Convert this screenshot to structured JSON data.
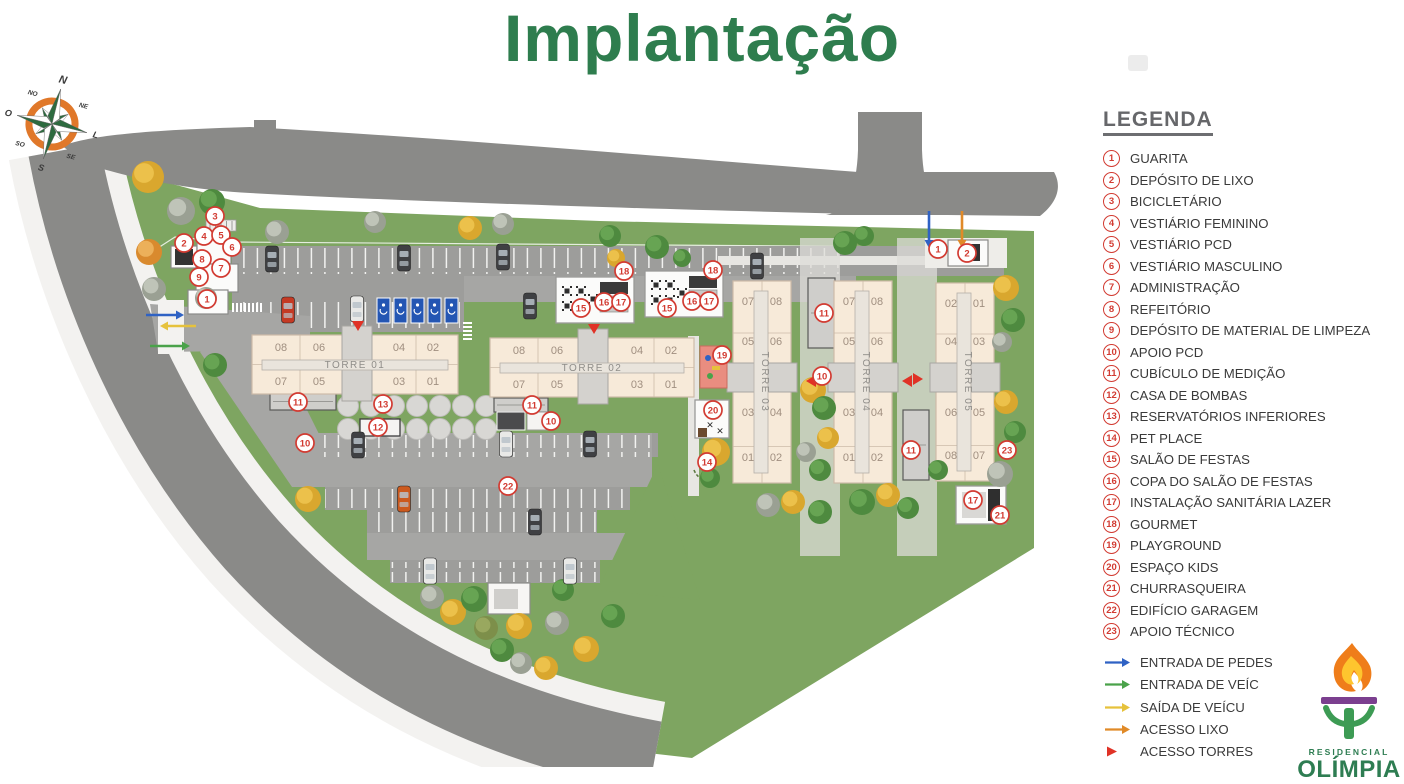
{
  "title": "Implantação",
  "legend": {
    "heading": "LEGENDA",
    "items": [
      {
        "n": "1",
        "label": "GUARITA"
      },
      {
        "n": "2",
        "label": "DEPÓSITO DE LIXO"
      },
      {
        "n": "3",
        "label": "BICICLETÁRIO"
      },
      {
        "n": "4",
        "label": "VESTIÁRIO FEMININO"
      },
      {
        "n": "5",
        "label": "VESTIÁRIO PCD"
      },
      {
        "n": "6",
        "label": "VESTIÁRIO MASCULINO"
      },
      {
        "n": "7",
        "label": "ADMINISTRAÇÃO"
      },
      {
        "n": "8",
        "label": "REFEITÓRIO"
      },
      {
        "n": "9",
        "label": "DEPÓSITO DE MATERIAL DE LIMPEZA"
      },
      {
        "n": "10",
        "label": "APOIO PCD"
      },
      {
        "n": "11",
        "label": "CUBÍCULO DE MEDIÇÃO"
      },
      {
        "n": "12",
        "label": "CASA DE BOMBAS"
      },
      {
        "n": "13",
        "label": "RESERVATÓRIOS INFERIORES"
      },
      {
        "n": "14",
        "label": "PET PLACE"
      },
      {
        "n": "15",
        "label": "SALÃO DE FESTAS"
      },
      {
        "n": "16",
        "label": "COPA DO SALÃO DE FESTAS"
      },
      {
        "n": "17",
        "label": "INSTALAÇÃO SANITÁRIA LAZER"
      },
      {
        "n": "18",
        "label": "GOURMET"
      },
      {
        "n": "19",
        "label": "PLAYGROUND"
      },
      {
        "n": "20",
        "label": "ESPAÇO KIDS"
      },
      {
        "n": "21",
        "label": "CHURRASQUEIRA"
      },
      {
        "n": "22",
        "label": "EDIFÍCIO GARAGEM"
      },
      {
        "n": "23",
        "label": "APOIO TÉCNICO"
      }
    ],
    "flows": [
      {
        "type": "arrow",
        "color": "#2f62c4",
        "label": "ENTRADA DE PEDES"
      },
      {
        "type": "arrow",
        "color": "#4aa24a",
        "label": "ENTRADA DE VEÍC"
      },
      {
        "type": "arrow",
        "color": "#e6c23c",
        "label": "SAÍDA DE  VEÍCU"
      },
      {
        "type": "arrow",
        "color": "#e08a28",
        "label": "ACESSO LIXO"
      },
      {
        "type": "triangle",
        "color": "#e03226",
        "label": "ACESSO TORRES"
      }
    ]
  },
  "logo": {
    "residencial": "RESIDENCIAL",
    "name": "OLÍMPIA"
  },
  "compass": {
    "labels": [
      "N",
      "NE",
      "L",
      "SE",
      "S",
      "SO",
      "O",
      "NO"
    ]
  },
  "plan": {
    "colors": {
      "grass": "#7ea561",
      "road": "#8a8a88",
      "sidewalk": "#f3f2f0",
      "lot": "#9d9d9b",
      "drive": "#a6a6a4",
      "slab": "#f7ead9",
      "slab_border": "#cdbba8",
      "core": "#d4d2ce",
      "bar": "#e9e4dc",
      "unit_text": "#a08f80",
      "tower_text": "#8f8d89",
      "marker": "#d23b32",
      "pcd": "#2456b3",
      "playground": "#e98d80",
      "arrow_blue": "#2f62c4",
      "arrow_green": "#4aa24a",
      "arrow_yellow": "#e6c23c",
      "arrow_orange": "#e08a28",
      "accent_red": "#e03226"
    },
    "towers": [
      {
        "name": "TORRE 01",
        "dir": "h",
        "slab": [
          252,
          335,
          206,
          59
        ],
        "core": [
          342,
          326,
          30,
          75
        ],
        "bar": [
          262,
          360,
          186,
          10
        ],
        "label": [
          355,
          368
        ],
        "cols": [
          281,
          319,
          399,
          433
        ],
        "rows": [
          351,
          385
        ],
        "units": [
          [
            "08",
            "06",
            "04",
            "02"
          ],
          [
            "07",
            "05",
            "03",
            "01"
          ]
        ]
      },
      {
        "name": "TORRE 02",
        "dir": "h",
        "slab": [
          490,
          338,
          204,
          59
        ],
        "core": [
          578,
          329,
          30,
          75
        ],
        "bar": [
          500,
          363,
          184,
          10
        ],
        "label": [
          592,
          371
        ],
        "cols": [
          519,
          557,
          637,
          671
        ],
        "rows": [
          354,
          388
        ],
        "units": [
          [
            "08",
            "06",
            "04",
            "02"
          ],
          [
            "07",
            "05",
            "03",
            "01"
          ]
        ]
      },
      {
        "name": "TORRE 03",
        "dir": "v",
        "slab": [
          733,
          281,
          58,
          202
        ],
        "core": [
          727,
          363,
          70,
          29
        ],
        "bar": [
          754,
          291,
          14,
          182
        ],
        "label": [
          762,
          382
        ],
        "cols": [
          748,
          776
        ],
        "rows": [
          305,
          345,
          416,
          461
        ],
        "units": [
          [
            "07",
            "08"
          ],
          [
            "05",
            "06"
          ],
          [
            "03",
            "04"
          ],
          [
            "01",
            "02"
          ]
        ]
      },
      {
        "name": "TORRE 04",
        "dir": "v",
        "slab": [
          834,
          281,
          58,
          202
        ],
        "core": [
          828,
          363,
          70,
          29
        ],
        "bar": [
          855,
          291,
          14,
          182
        ],
        "label": [
          863,
          382
        ],
        "cols": [
          849,
          877
        ],
        "rows": [
          305,
          345,
          416,
          461
        ],
        "units": [
          [
            "07",
            "08"
          ],
          [
            "05",
            "06"
          ],
          [
            "03",
            "04"
          ],
          [
            "01",
            "02"
          ]
        ]
      },
      {
        "name": "TORRE 05",
        "dir": "v",
        "slab": [
          936,
          283,
          58,
          198
        ],
        "core": [
          930,
          363,
          70,
          29
        ],
        "bar": [
          957,
          293,
          14,
          178
        ],
        "label": [
          965,
          382
        ],
        "cols": [
          951,
          979
        ],
        "rows": [
          307,
          345,
          416,
          459
        ],
        "units": [
          [
            "02",
            "01"
          ],
          [
            "04",
            "03"
          ],
          [
            "06",
            "05"
          ],
          [
            "08",
            "07"
          ]
        ]
      }
    ],
    "markers": [
      [
        "3",
        215,
        216
      ],
      [
        "4",
        204,
        236
      ],
      [
        "5",
        221,
        235
      ],
      [
        "2",
        184,
        243
      ],
      [
        "6",
        232,
        247
      ],
      [
        "8",
        202,
        259
      ],
      [
        "7",
        221,
        268
      ],
      [
        "9",
        199,
        277
      ],
      [
        "1",
        207,
        299
      ],
      [
        "18",
        624,
        271
      ],
      [
        "15",
        581,
        308
      ],
      [
        "16",
        604,
        302
      ],
      [
        "17",
        621,
        302
      ],
      [
        "18",
        713,
        270
      ],
      [
        "15",
        667,
        308
      ],
      [
        "16",
        692,
        301
      ],
      [
        "17",
        709,
        301
      ],
      [
        "1",
        938,
        249
      ],
      [
        "2",
        967,
        253
      ],
      [
        "11",
        298,
        402
      ],
      [
        "13",
        383,
        404
      ],
      [
        "12",
        378,
        427
      ],
      [
        "10",
        305,
        443
      ],
      [
        "11",
        532,
        405
      ],
      [
        "10",
        551,
        421
      ],
      [
        "19",
        722,
        355
      ],
      [
        "20",
        713,
        410
      ],
      [
        "14",
        707,
        462
      ],
      [
        "11",
        824,
        313
      ],
      [
        "10",
        822,
        376
      ],
      [
        "11",
        911,
        450
      ],
      [
        "23",
        1007,
        450
      ],
      [
        "17",
        973,
        500
      ],
      [
        "21",
        1000,
        515
      ],
      [
        "22",
        508,
        486
      ]
    ],
    "triangles": [
      [
        358,
        329,
        "d"
      ],
      [
        594,
        332,
        "d"
      ],
      [
        808,
        381,
        "l"
      ],
      [
        904,
        381,
        "l"
      ],
      [
        921,
        379,
        "r"
      ]
    ],
    "arrows": [
      [
        146,
        315,
        176,
        315,
        "#2f62c4"
      ],
      [
        196,
        326,
        168,
        326,
        "#e6c23c"
      ],
      [
        150,
        346,
        182,
        346,
        "#4aa24a"
      ],
      [
        929,
        211,
        929,
        240,
        "#2f62c4"
      ],
      [
        962,
        211,
        962,
        240,
        "#e08a28"
      ]
    ],
    "trees": [
      [
        148,
        177,
        16,
        "y"
      ],
      [
        181,
        211,
        14,
        "gy"
      ],
      [
        212,
        202,
        13,
        "g"
      ],
      [
        149,
        252,
        13,
        "o"
      ],
      [
        154,
        289,
        12,
        "gy"
      ],
      [
        206,
        298,
        11,
        "gy"
      ],
      [
        215,
        365,
        12,
        "g"
      ],
      [
        277,
        232,
        12,
        "gy"
      ],
      [
        375,
        222,
        11,
        "gy"
      ],
      [
        470,
        228,
        12,
        "y"
      ],
      [
        503,
        224,
        11,
        "gy"
      ],
      [
        616,
        258,
        9,
        "y"
      ],
      [
        682,
        258,
        9,
        "g"
      ],
      [
        610,
        236,
        11,
        "g"
      ],
      [
        657,
        247,
        12,
        "g"
      ],
      [
        845,
        243,
        12,
        "g"
      ],
      [
        864,
        236,
        10,
        "g"
      ],
      [
        1006,
        288,
        13,
        "y"
      ],
      [
        1013,
        320,
        12,
        "g"
      ],
      [
        1002,
        342,
        10,
        "gy"
      ],
      [
        1006,
        402,
        12,
        "y"
      ],
      [
        1015,
        432,
        11,
        "g"
      ],
      [
        1000,
        474,
        13,
        "gy"
      ],
      [
        813,
        390,
        13,
        "y"
      ],
      [
        824,
        408,
        12,
        "g"
      ],
      [
        828,
        438,
        11,
        "y"
      ],
      [
        806,
        452,
        10,
        "gy"
      ],
      [
        820,
        470,
        11,
        "g"
      ],
      [
        768,
        505,
        12,
        "gy"
      ],
      [
        793,
        502,
        12,
        "y"
      ],
      [
        820,
        512,
        12,
        "g"
      ],
      [
        862,
        502,
        13,
        "g"
      ],
      [
        888,
        495,
        12,
        "y"
      ],
      [
        908,
        508,
        11,
        "g"
      ],
      [
        938,
        470,
        10,
        "g"
      ],
      [
        716,
        452,
        14,
        "y"
      ],
      [
        710,
        478,
        10,
        "g"
      ],
      [
        308,
        499,
        13,
        "y"
      ],
      [
        432,
        597,
        12,
        "gy"
      ],
      [
        453,
        612,
        13,
        "y"
      ],
      [
        474,
        599,
        13,
        "g"
      ],
      [
        486,
        628,
        12,
        "ol"
      ],
      [
        519,
        626,
        13,
        "y"
      ],
      [
        557,
        623,
        12,
        "gy"
      ],
      [
        502,
        650,
        12,
        "g"
      ],
      [
        521,
        663,
        11,
        "gy"
      ],
      [
        546,
        668,
        12,
        "y"
      ],
      [
        586,
        649,
        13,
        "y"
      ],
      [
        613,
        616,
        12,
        "g"
      ],
      [
        563,
        590,
        11,
        "g"
      ]
    ],
    "cars": [
      [
        272,
        259,
        "#3f4043"
      ],
      [
        404,
        258,
        "#3f4043"
      ],
      [
        503,
        257,
        "#3f4043"
      ],
      [
        757,
        266,
        "#3f4043"
      ],
      [
        288,
        310,
        "#c43a24"
      ],
      [
        357,
        309,
        "#e9e9e7"
      ],
      [
        530,
        306,
        "#3f4043"
      ],
      [
        358,
        445,
        "#3f4043"
      ],
      [
        506,
        444,
        "#e9e9e7"
      ],
      [
        590,
        444,
        "#3f4043"
      ],
      [
        404,
        499,
        "#cc5a1e"
      ],
      [
        535,
        522,
        "#3f4043"
      ],
      [
        430,
        571,
        "#e9e9e7"
      ],
      [
        570,
        571,
        "#e9e9e7"
      ]
    ]
  }
}
